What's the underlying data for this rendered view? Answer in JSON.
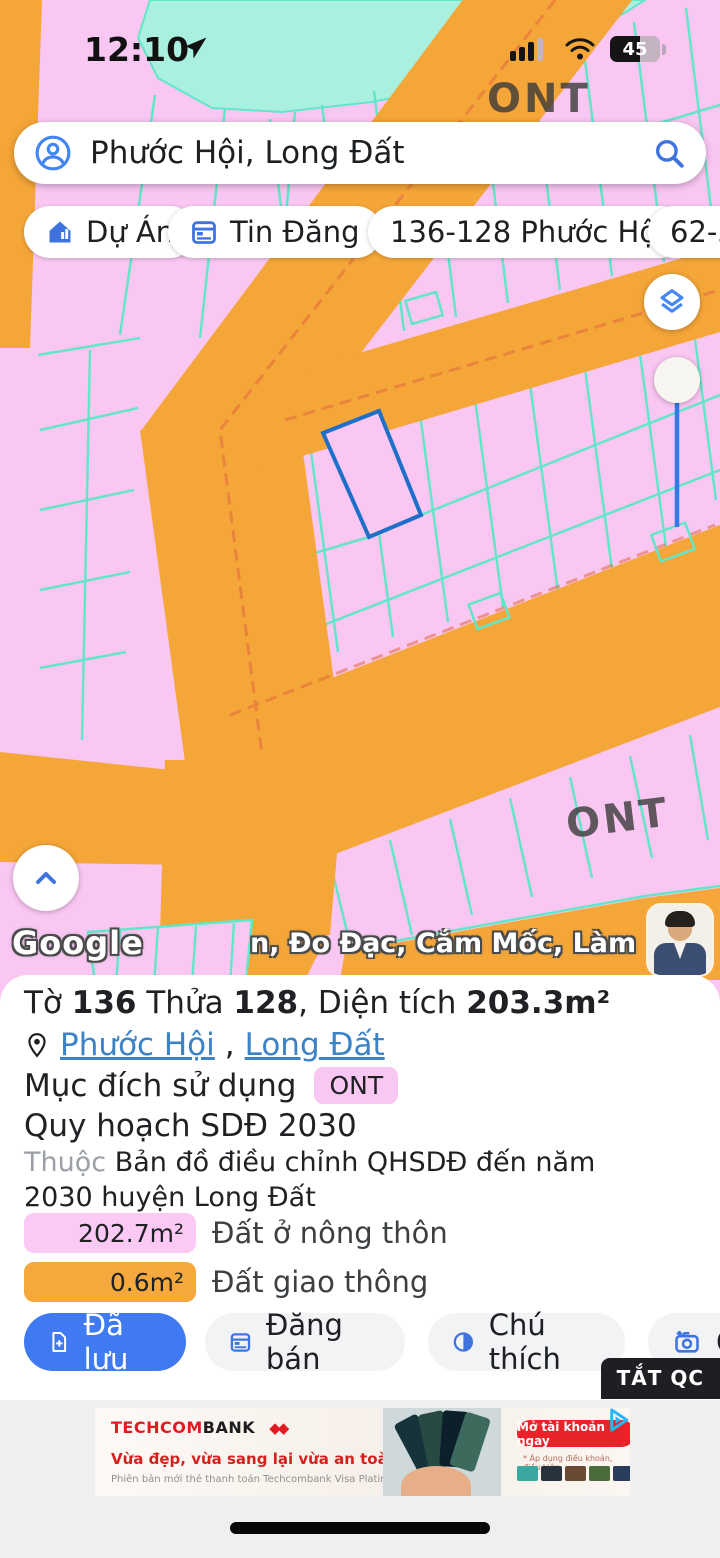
{
  "status_bar": {
    "time": "12:10",
    "battery_percent": "45"
  },
  "search": {
    "value": "Phước Hội, Long Đất"
  },
  "chips": [
    {
      "label": "Dự Án",
      "icon": "house"
    },
    {
      "label": "Tin Đăng",
      "icon": "calendar"
    },
    {
      "label": "136-128 Phước Hội",
      "icon": null
    },
    {
      "label": "62-37",
      "icon": null
    }
  ],
  "map": {
    "zone_label_top": "ONT",
    "zone_label_bottom": "ONT",
    "google_logo": "Google",
    "watermark": "n, Đo Đạc, Cắm Mốc, Làm Hồ Sơ",
    "colors": {
      "parcel_fill": "#fac7f3",
      "road_fill": "#f5a638",
      "parcel_line": "#63e6c8",
      "water_fill": "#aaf0e0",
      "selected_parcel_stroke": "#1e6fc8"
    }
  },
  "parcel_panel": {
    "title": {
      "t1": "Tờ ",
      "v1": "136",
      "t2": " Thửa ",
      "v2": "128",
      "t3": ", Diện tích ",
      "v3": "203.3m²"
    },
    "location": {
      "link1": "Phước Hội",
      "separator": ",",
      "link2": "Long Đất"
    },
    "usage_label": "Mục đích sử dụng",
    "usage_badge": "ONT",
    "planning": "Quy hoạch SDĐ 2030",
    "belongs_label": "Thuộc",
    "belongs_value": "Bản đồ điều chỉnh QHSDĐ đến năm 2030 huyện Long Đất",
    "legend": [
      {
        "area": "202.7m²",
        "label": "Đất ở nông thôn",
        "color": "#fbc9f4"
      },
      {
        "area": "0.6m²",
        "label": "Đất giao thông",
        "color": "#f5a83b"
      }
    ],
    "buttons": {
      "saved": "Đã lưu",
      "post": "Đăng bán",
      "legend_btn": "Chú thích",
      "camera": "C"
    },
    "ad_dismiss": "TẮT QC"
  },
  "ad": {
    "brand_red": "TECHCOM",
    "brand_dark": "BANK",
    "tagline": "Vừa đẹp, vừa sang lại vừa an toàn",
    "subtext": "Phiên bản mới thẻ thanh toán Techcombank Visa Platinum",
    "cta": "Mở tài khoản ngay",
    "disclaimer": "* Áp dụng điều khoản, điều kiện"
  }
}
